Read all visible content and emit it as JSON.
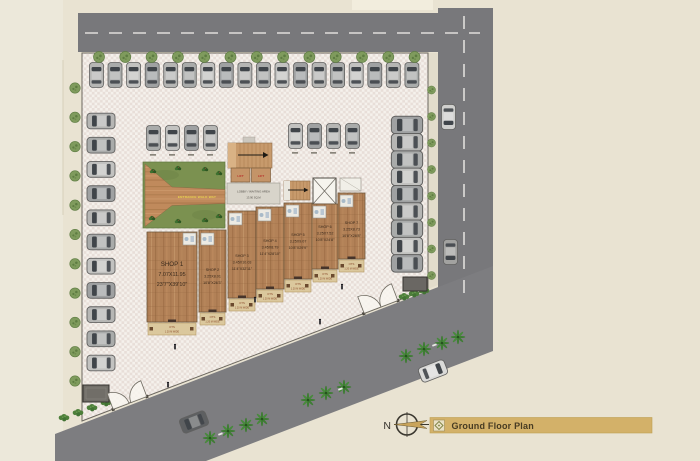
{
  "legend": {
    "north_label": "N",
    "plan_title": "Ground Floor Plan"
  },
  "building": {
    "entrance_walkway_label": "ENTRANCE WALK WAY",
    "lobby_line1": "LOBBY / WAITING AREA",
    "lobby_line2": "13.90 SQ.M",
    "lift_left_label": "LIFT",
    "lift_right_label": "LIFT",
    "ots_label": "OTS",
    "ots_width_label": "1.20 M WIDE",
    "shops": [
      {
        "name": "SHOP 1",
        "metric": "7.07X11.95",
        "imperial": "23'7\"X39'10\""
      },
      {
        "name": "SHOP 2",
        "metric": "3.25X8.01",
        "imperial": "10'8\"X26'3\""
      },
      {
        "name": "SHOP 3",
        "metric": "3.45X10.03",
        "imperial": "11'4\"X32'11\""
      },
      {
        "name": "SHOP 4",
        "metric": "3.45X8.79",
        "imperial": "11'4\"X28'10\""
      },
      {
        "name": "SHOP 5",
        "metric": "3.25X9.07",
        "imperial": "10'8\"X29'9\""
      },
      {
        "name": "SHOP 6",
        "metric": "3.25X7.52",
        "imperial": "10'8\"X24'8\""
      },
      {
        "name": "SHOP 7",
        "metric": "3.25X8.73",
        "imperial": "10'8\"X28'8\""
      }
    ]
  },
  "colors": {
    "road": "#78787b",
    "plaza": "#f5f1ec",
    "plaza_check": "#e8ded8",
    "wood": "#b28157",
    "grass": "#7b9150",
    "beige": "#e9e3d2",
    "banner": "#d3b169"
  }
}
